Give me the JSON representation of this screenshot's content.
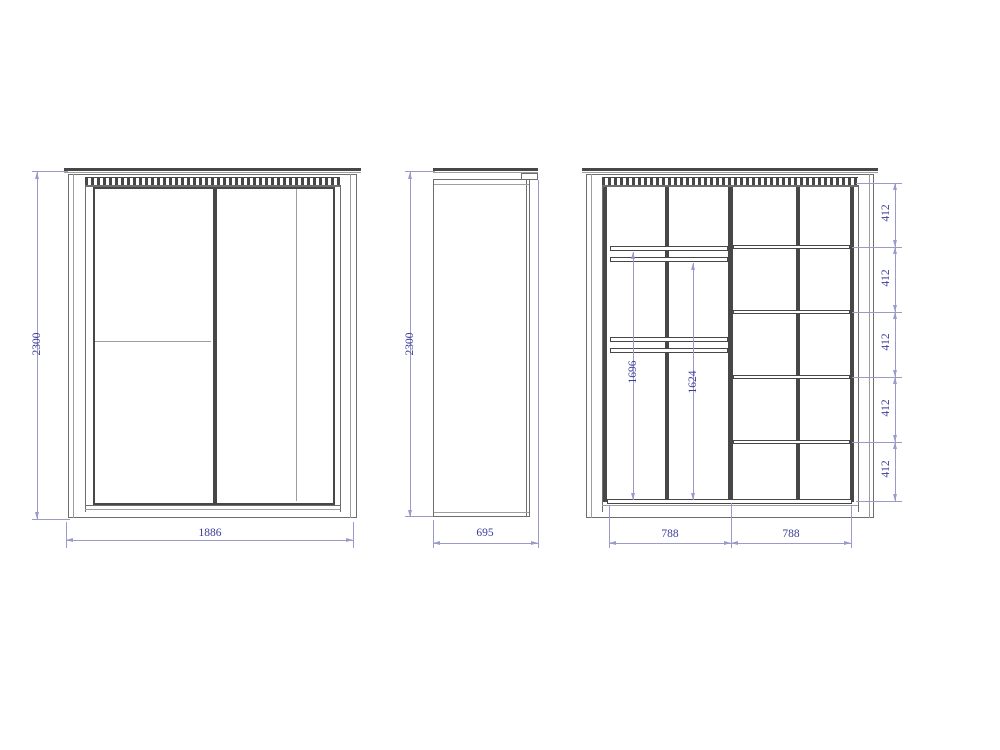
{
  "drawing": {
    "type": "furniture-technical-drawing",
    "colors": {
      "line": "#474747",
      "mid": "#6e6e6e",
      "thin": "#9e9e9e",
      "dim": "#9b9bca",
      "dimtext": "#3b3b99",
      "bg": "#ffffff"
    },
    "views": {
      "front": {
        "height": "2300",
        "width": "1886"
      },
      "side": {
        "height": "2300",
        "depth": "695"
      },
      "internal": {
        "shelf_spacings": [
          "412",
          "412",
          "412",
          "412",
          "412"
        ],
        "rail_heights": [
          "1696",
          "1624"
        ],
        "section_widths": [
          "788",
          "788"
        ]
      }
    }
  }
}
